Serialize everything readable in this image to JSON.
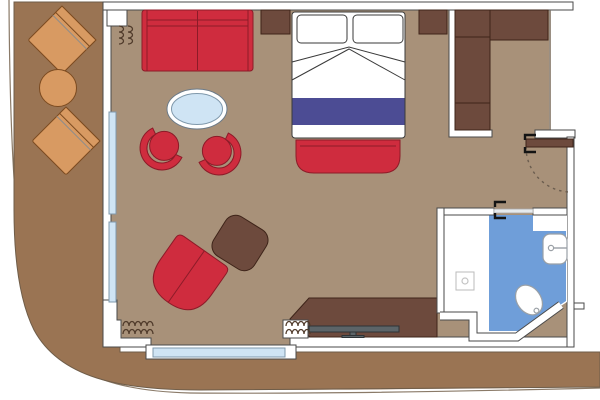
{
  "colors": {
    "page_bg": "#ffffff",
    "deck_brown": "#9a7453",
    "deck_line": "#6f5d49",
    "hull_line": "#8a7a68",
    "floor_taupe": "#a89179",
    "wall_line": "#4a4a4a",
    "red": "#cf2c3e",
    "red_line": "#8c1b28",
    "wood": "#6d4a3d",
    "wood_line": "#3e2419",
    "balcony_wood": "#d89a62",
    "balcony_wood_line": "#7c4b20",
    "window_blue": "#cfe4f4",
    "window_line": "#7f98ab",
    "bath_blue": "#6f9ed9",
    "fixture_line": "#9aa0a6",
    "bed_line": "#3a3a3a",
    "blanket_purple": "#4c4c94",
    "curtain_brown": "#4f3a2a",
    "tv_gray": "#5c6468",
    "arc_dash": "#6b5d4f"
  },
  "plan": {
    "balcony": {
      "items": [
        "lounge-chair",
        "lounge-chair",
        "round-table"
      ]
    },
    "cabin": {
      "items": [
        "sofa",
        "side-table",
        "double-bed",
        "pillow",
        "pillow",
        "bed-bench",
        "nightstand",
        "wardrobe",
        "oval-table",
        "tub-chair",
        "tub-chair",
        "armchair",
        "ottoman",
        "desk",
        "tv"
      ],
      "windows": [
        "balcony-window-left",
        "balcony-window-bottom"
      ],
      "curtains": 3
    },
    "bathroom": {
      "items": [
        "shower",
        "sink",
        "toilet"
      ],
      "wet_area_color_key": "bath_blue"
    },
    "doors": [
      "entry-door",
      "bathroom-door"
    ]
  }
}
